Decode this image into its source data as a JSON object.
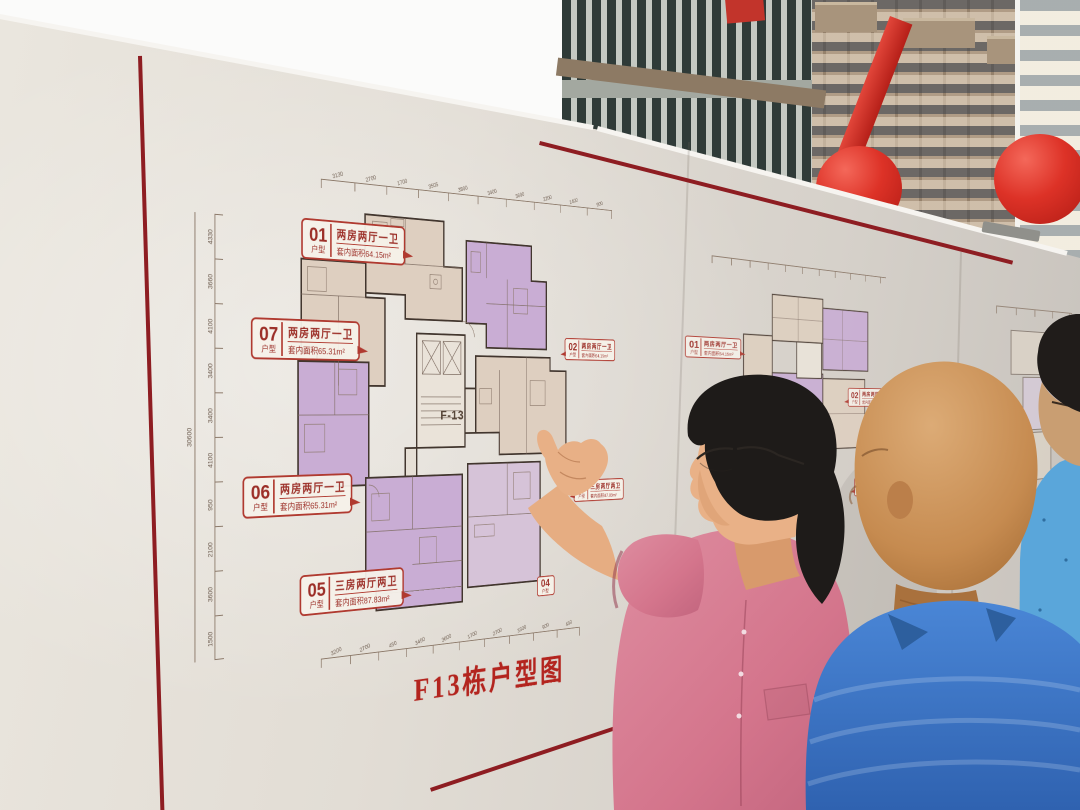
{
  "board": {
    "panel1": {
      "title": "F13栋户型图",
      "core_label": "F-13",
      "note": "注：1、三房五厅户型",
      "callouts": [
        {
          "id": "01",
          "suffix": "户型",
          "desc": "两房两厅一卫",
          "area": "套内面积64.15m²"
        },
        {
          "id": "07",
          "suffix": "户型",
          "desc": "两房两厅一卫",
          "area": "套内面积65.31m²"
        },
        {
          "id": "06",
          "suffix": "户型",
          "desc": "两房两厅一卫",
          "area": "套内面积65.31m²"
        },
        {
          "id": "05",
          "suffix": "户型",
          "desc": "三房两厅两卫",
          "area": "套内面积87.83m²"
        },
        {
          "id": "02",
          "suffix": "户型",
          "desc": "两房两厅一卫",
          "area": "套内面积64.15m²"
        },
        {
          "id": "03",
          "suffix": "户型",
          "desc": "三房两厅两卫",
          "area": "套内面积87.83m²"
        },
        {
          "id": "04",
          "suffix": "户型",
          "desc": "",
          "area": ""
        }
      ],
      "rulers": {
        "left_total": "30600",
        "left": [
          "4330",
          "3660",
          "4100",
          "3400",
          "3400",
          "4100",
          "950",
          "2100",
          "3600",
          "1500"
        ],
        "top": [
          "3130",
          "2700",
          "1700",
          "3505",
          "3800",
          "3400",
          "3600",
          "2200",
          "1400",
          "900"
        ],
        "bottom": [
          "3200",
          "2700",
          "450",
          "3450",
          "3600",
          "1700",
          "2700",
          "3300",
          "900",
          "450"
        ]
      }
    },
    "panel2": {
      "callouts": [
        {
          "id": "01",
          "suffix": "户型",
          "desc": "两房两厅一卫",
          "area": "套内面积64.15m²"
        },
        {
          "id": "02",
          "suffix": "户型",
          "desc": "两房两厅一卫",
          "area": "套内面积64.15m²"
        },
        {
          "id": "03",
          "suffix": "户型",
          "desc": "三房两厅两卫",
          "area": "套内面积87.83m²"
        },
        {
          "id": "06",
          "suffix": "户型",
          "desc": "两房两厅一卫",
          "area": "套内面积65.31m²"
        }
      ]
    }
  },
  "colors": {
    "accent_red": "#b03a30",
    "title_red": "#b3241e",
    "board_cream": "#ded9d1",
    "plan_purple": "#c9add4",
    "plan_beige": "#decfc0",
    "balloon_red": "#dd3227",
    "shirt_pink": "#d97e93",
    "shirt_blue": "#3d79c6",
    "shirt_blue_light": "#5aa6da"
  }
}
